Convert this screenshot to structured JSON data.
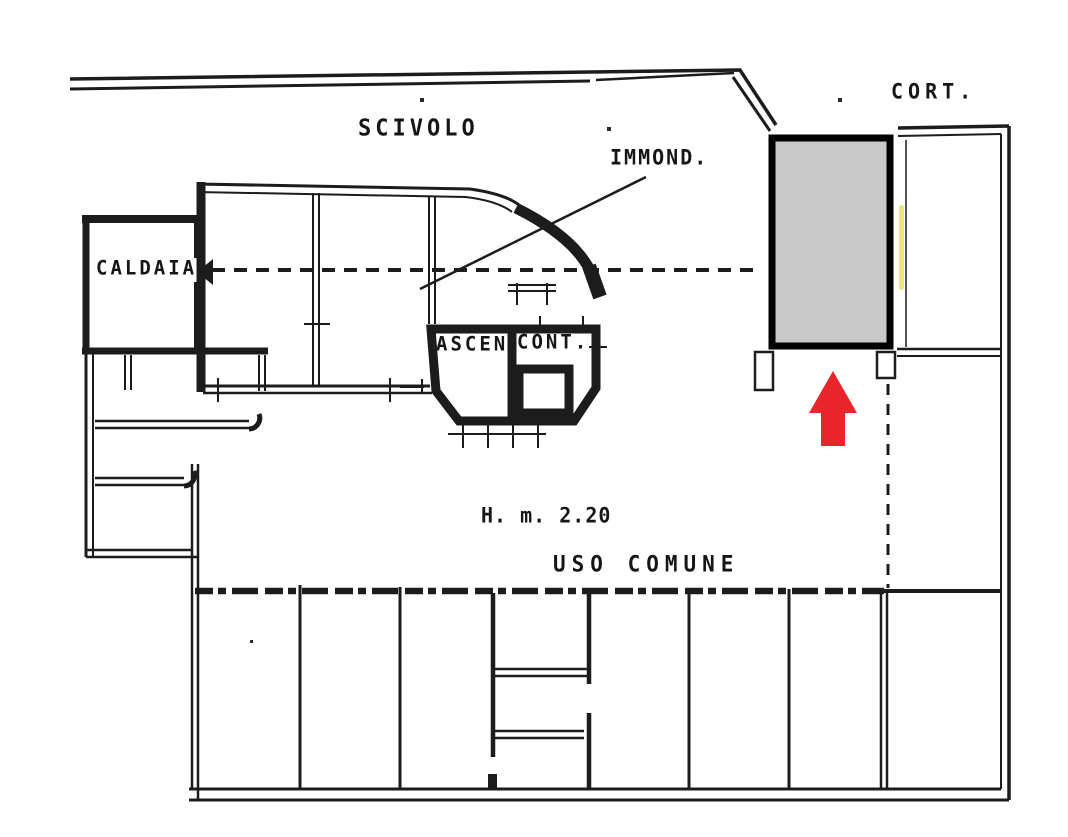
{
  "colors": {
    "background": "#ffffff",
    "ink": "#1c1c1c",
    "highlight_fill": "#c9c9c9",
    "highlight_border": "#000000",
    "arrow_red": "#e8252a",
    "marker_yellow": "#e9df66"
  },
  "floor_plan": {
    "labels": {
      "scivolo": "SCIVOLO",
      "immond": "IMMOND.",
      "cort": "CORT.",
      "caldaia": "CALDAIA",
      "ascen": "ASCEN",
      "cont": "CONT.",
      "height_note": "H. m. 2.20",
      "uso_comune": "USO COMUNE"
    },
    "highlighted_unit": {
      "description": "Gray shaded parking space indicated by red arrow"
    }
  }
}
